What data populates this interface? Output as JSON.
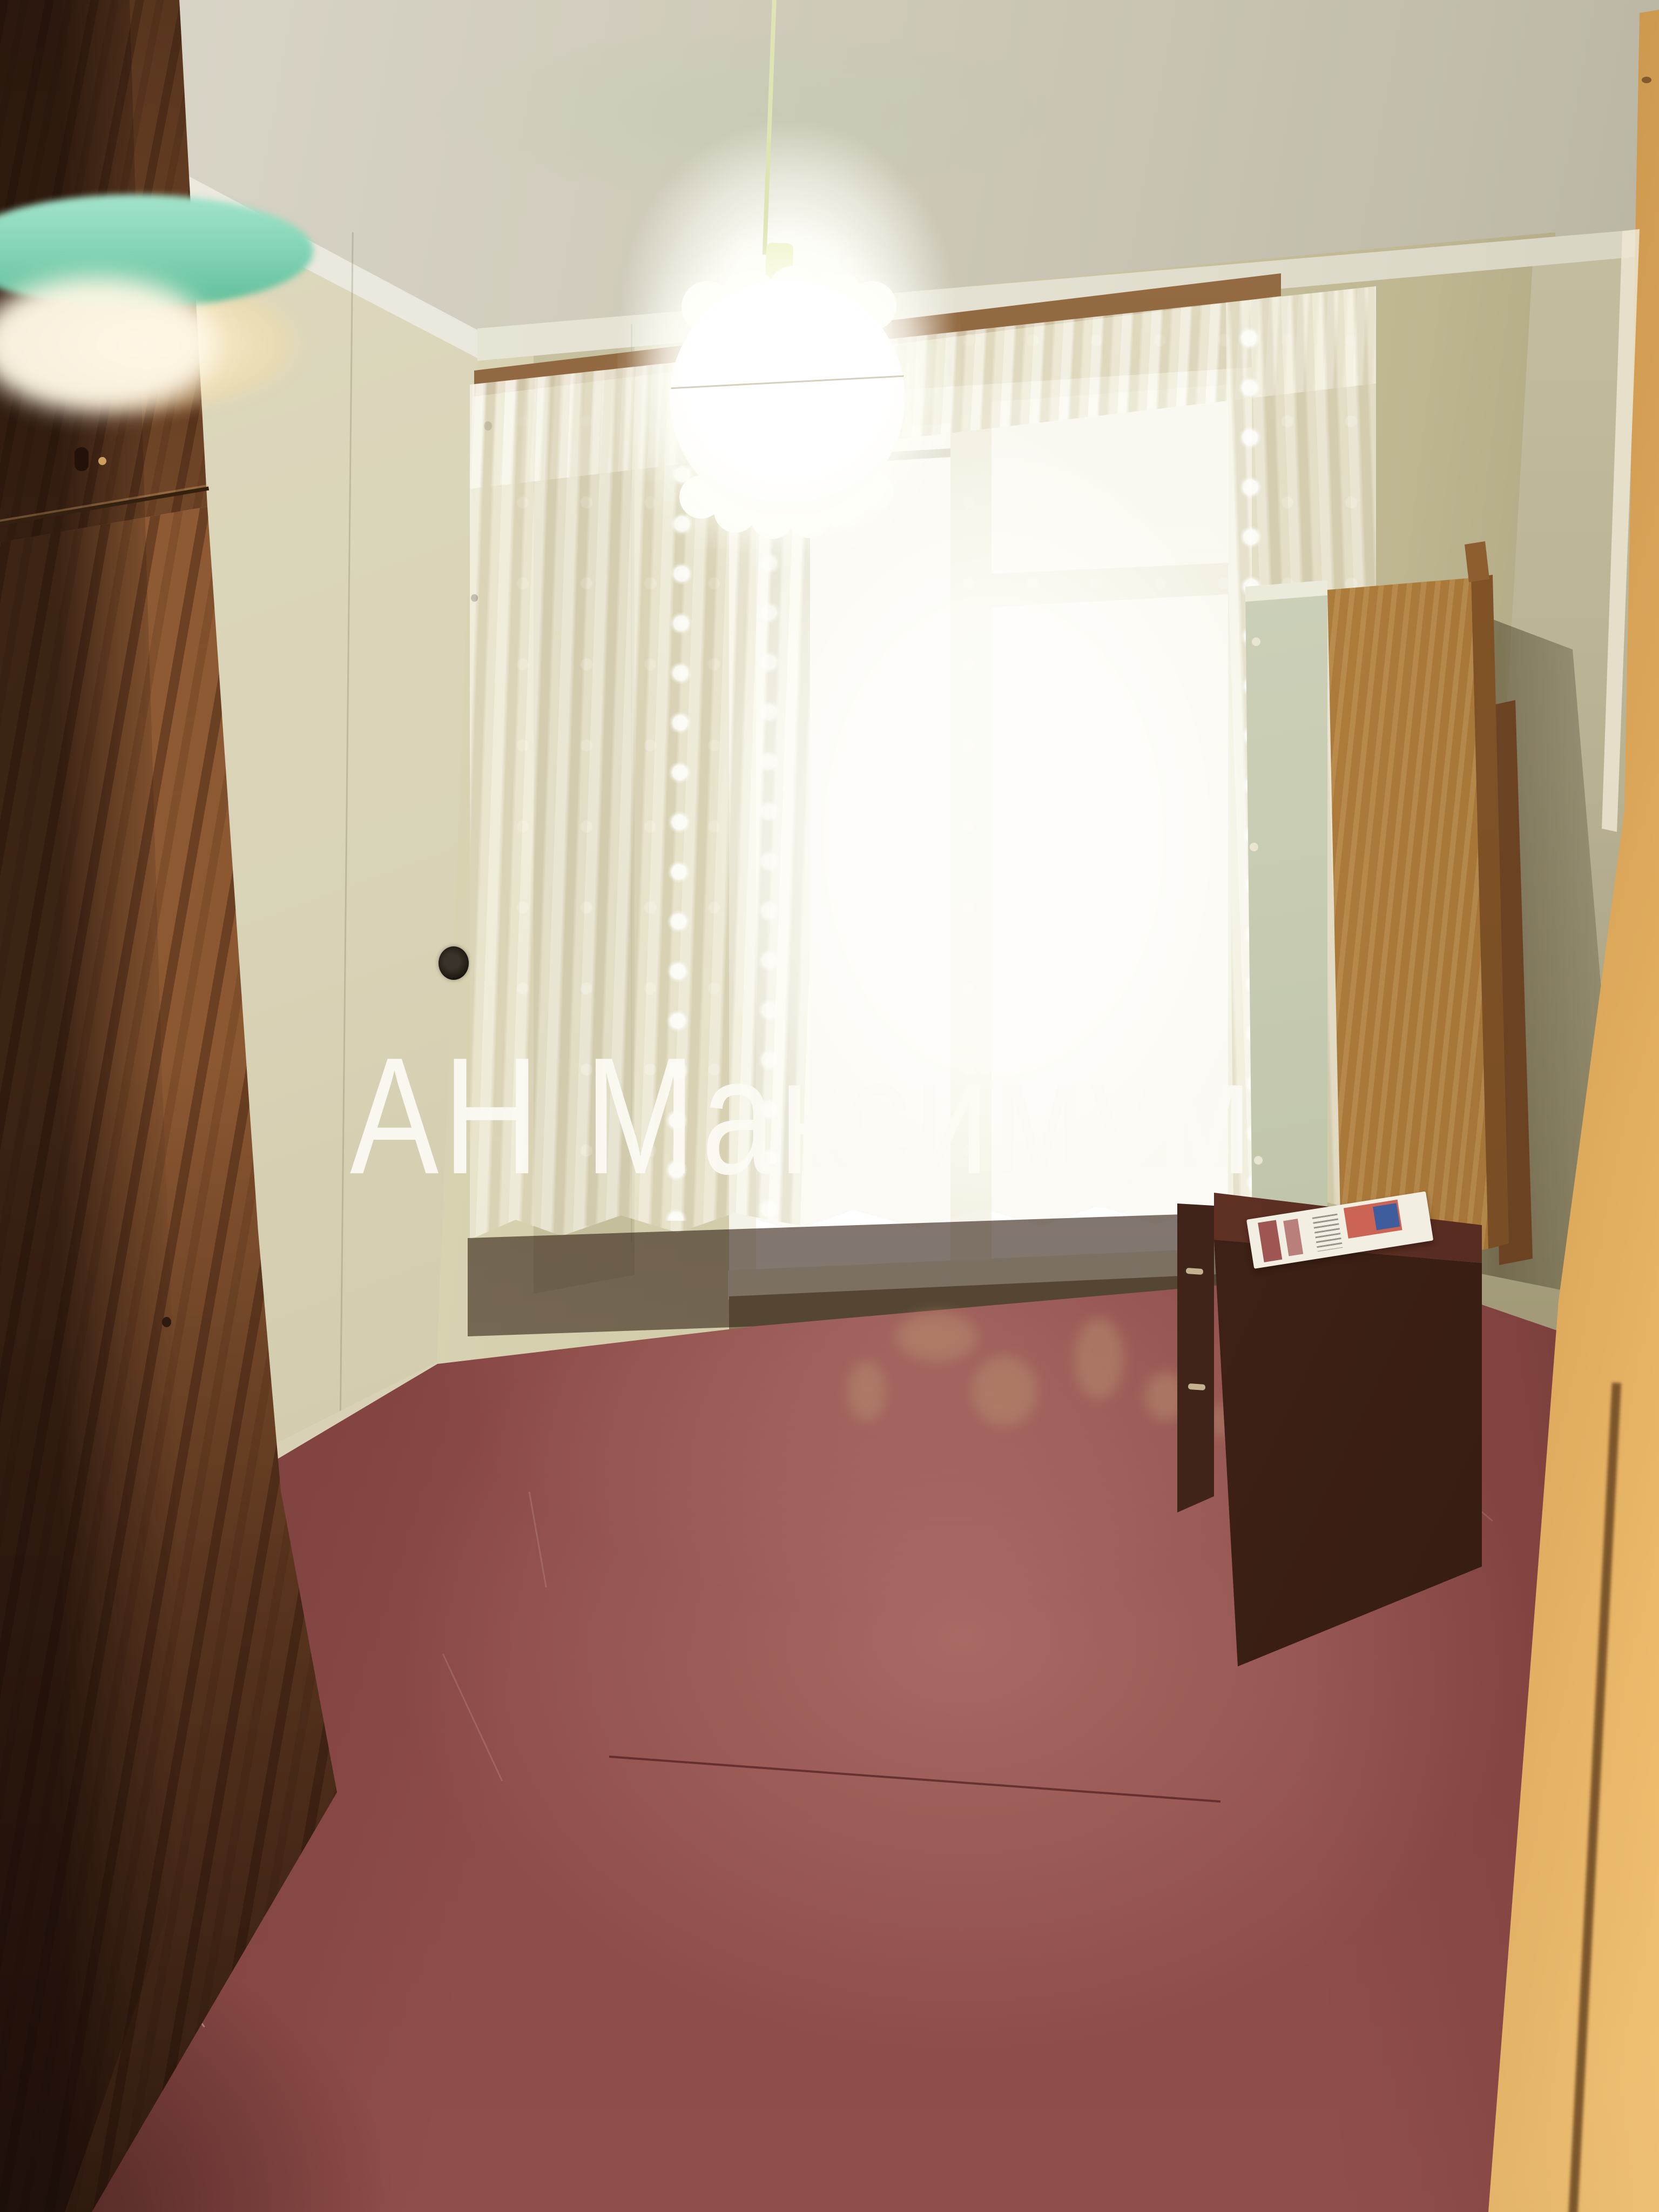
{
  "watermark": {
    "text": "АН Максимум"
  },
  "scene": {
    "objects": [
      "ceiling",
      "left-wall",
      "back-wall",
      "right-wall",
      "cornice",
      "curtain-rod",
      "window",
      "lace-sheer-curtains",
      "window-sill",
      "pendant-lamp",
      "lamp-cord",
      "green-lampshade-foreground",
      "wardrobe",
      "painted-floor",
      "baseboard",
      "mirror",
      "leaning-wood-panel",
      "dresser-cabinet",
      "newspaper",
      "room-door",
      "wall-socket",
      "nail-holes"
    ]
  },
  "colors": {
    "wall": "#d5d0b2",
    "wall-dark": "#a49d79",
    "ceiling": "#cfcaba",
    "cornice": "#e9e6d8",
    "rod": "#7c5531",
    "window-glow": "#ffffff",
    "curtain": "#f3eedc",
    "curtain-shadow": "#968c5f",
    "floor": "#8a4845",
    "floor-glare": "#cd968c",
    "floor-dark": "#5a2a28",
    "wardrobe-wood": "#83512d",
    "teal-lampshade": "#7fd2b2",
    "warm-glow": "#fff4d6",
    "panel-wood": "#b5833f",
    "mirror": "#c2c7ac",
    "cabinet": "#432418",
    "door": "#dda554",
    "newspaper-red": "#c64b3d",
    "newspaper-blue": "#3f5d9c",
    "socket": "#201a12",
    "watermark": "#fcfaf3"
  }
}
